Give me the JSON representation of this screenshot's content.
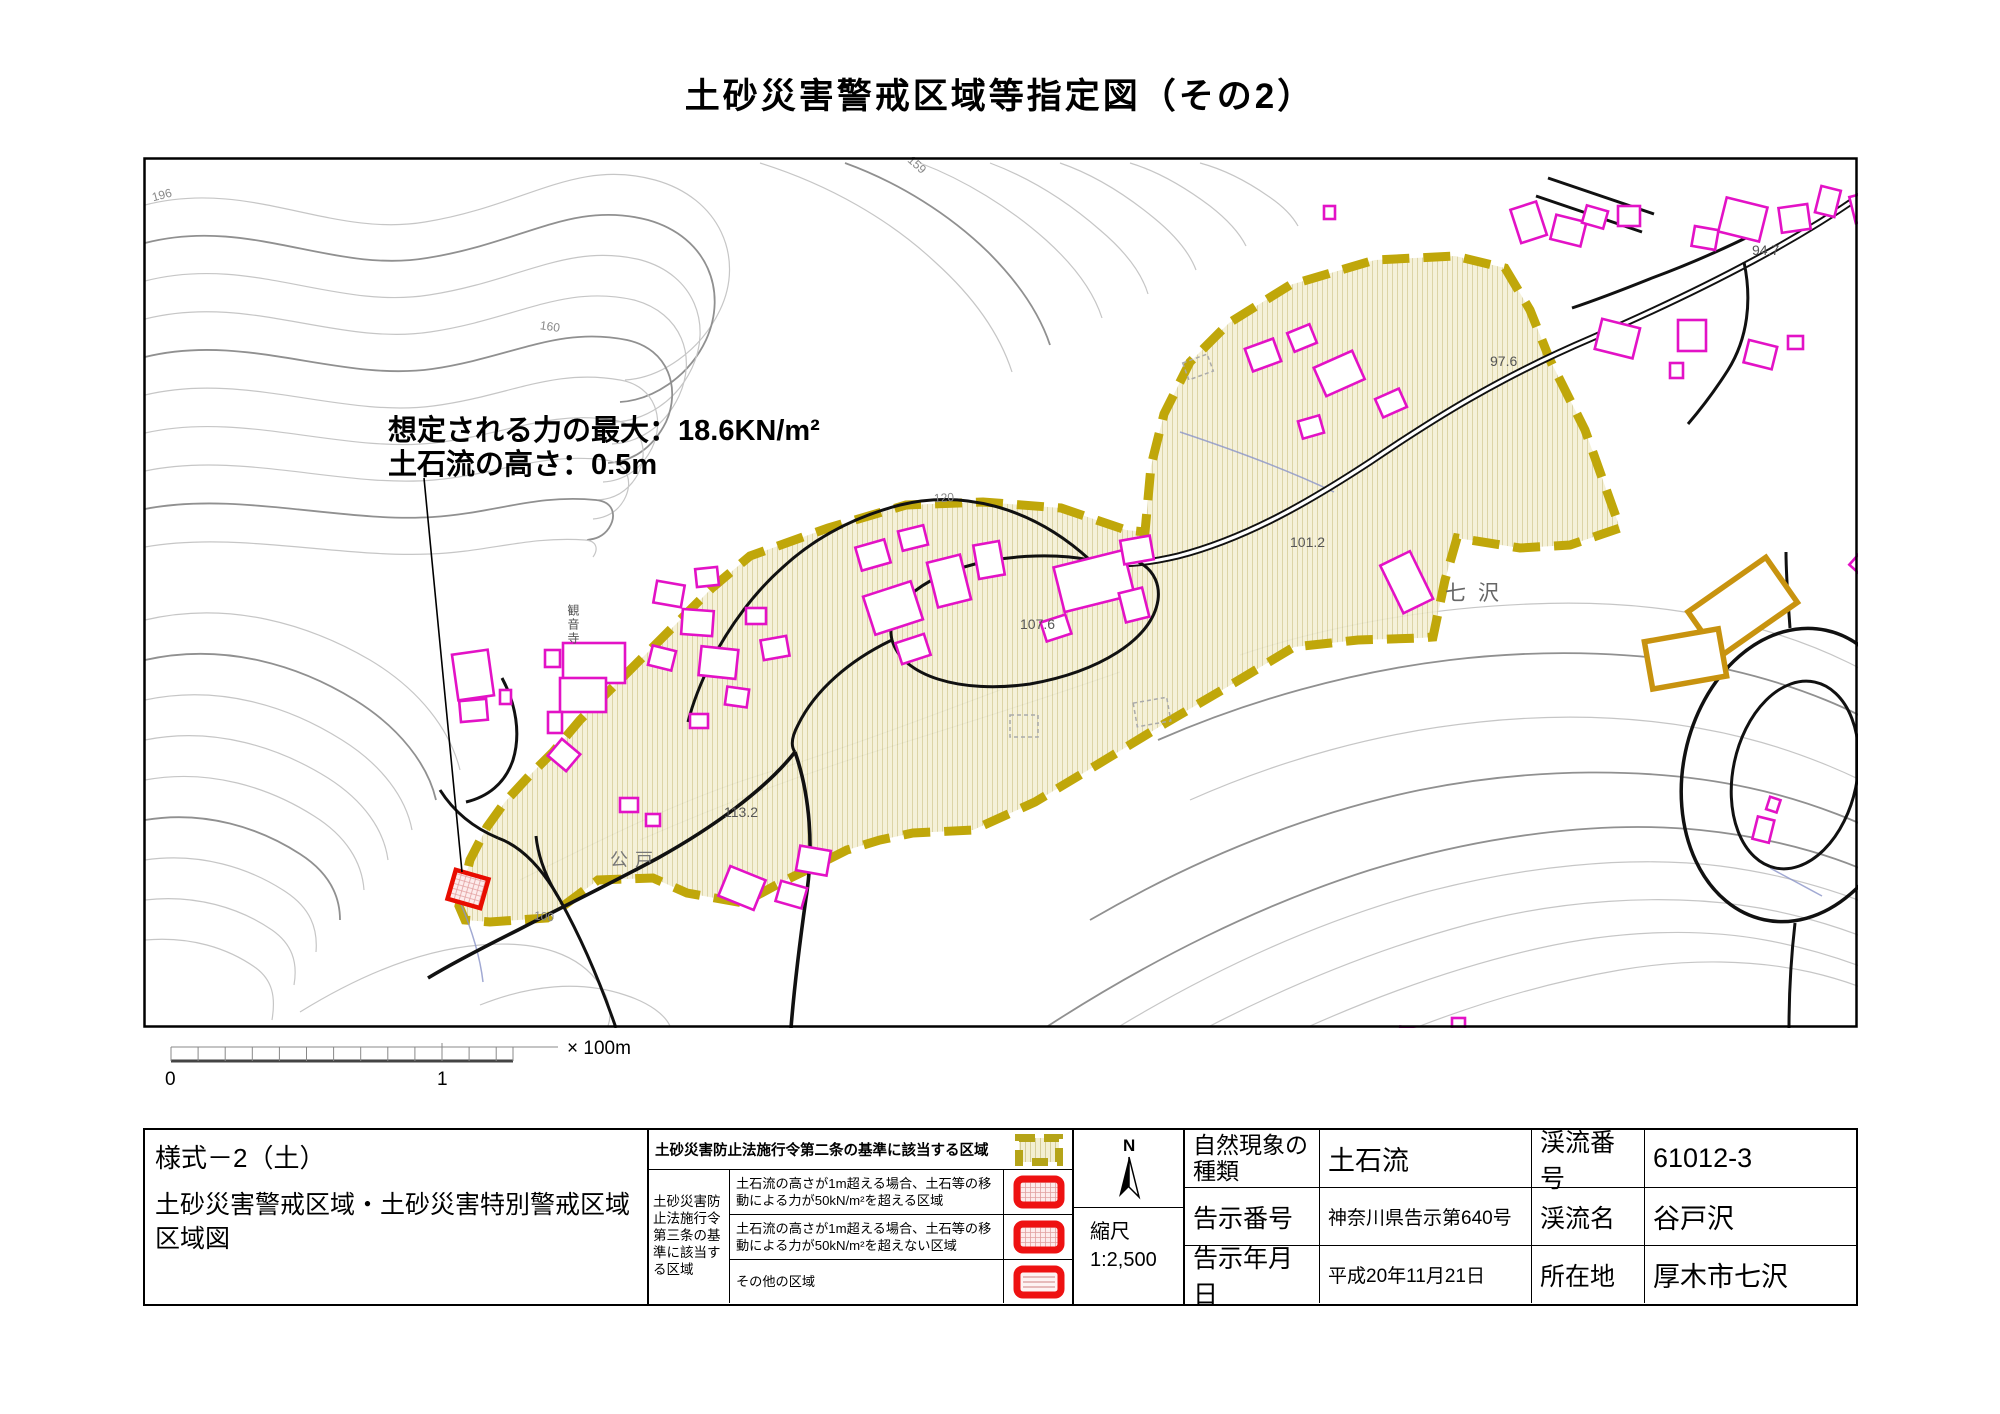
{
  "title": "土砂災害警戒区域等指定図（その2）",
  "annotation": {
    "line1": "想定される力の最大：18.6KN/m²",
    "line2": "土石流の高さ：0.5m"
  },
  "map_labels": {
    "place_nanasawa": "七沢",
    "place_koudo": "公戸",
    "temple": "観音寺",
    "elev_94_7": "94.7",
    "elev_97_6": "97.6",
    "elev_101_2": "101.2",
    "elev_107_6": "107.6",
    "elev_113_2": "113.2",
    "contour_196": "196",
    "contour_159": "159",
    "contour_160": "160",
    "contour_120": "120",
    "contour_100": "100"
  },
  "scale_bar": {
    "zero": "0",
    "one": "1",
    "unit": "× 100m"
  },
  "form": {
    "code": "様式－2（土）",
    "name": "土砂災害警戒区域・土砂災害特別警戒区域区域図"
  },
  "legend": {
    "row_a": "土砂災害防止法施行令第二条の基準に該当する区域",
    "group_label": "土砂災害防止法施行令第三条の基準に該当する区域",
    "row_b": "土石流の高さが1m超える場合、土石等の移動による力が50kN/m²を超える区域",
    "row_c": "土石流の高さが1m超える場合、土石等の移動による力が50kN/m²を超えない区域",
    "row_d": "その他の区域"
  },
  "compass": {
    "north": "N"
  },
  "scale": {
    "label": "縮尺",
    "value": "1:2,500"
  },
  "info": {
    "phenomenon_label": "自然現象の種類",
    "phenomenon": "土石流",
    "stream_no_label": "渓流番号",
    "stream_no": "61012-3",
    "notice_no_label": "告示番号",
    "notice_no": "神奈川県告示第640号",
    "stream_name_label": "渓流名",
    "stream_name": "谷戸沢",
    "notice_date_label": "告示年月日",
    "notice_date": "平成20年11月21日",
    "location_label": "所在地",
    "location": "厚木市七沢"
  },
  "colors": {
    "zone_boundary": "#c0a70a",
    "zone_fill": "#f3efd2",
    "building_outline": "#e312c6",
    "special_zone_red": "#e80c00",
    "legend_red": "#ee1111",
    "ochre_building": "#c8930f",
    "contour": "#c6c6c6",
    "index_contour": "#909090"
  }
}
